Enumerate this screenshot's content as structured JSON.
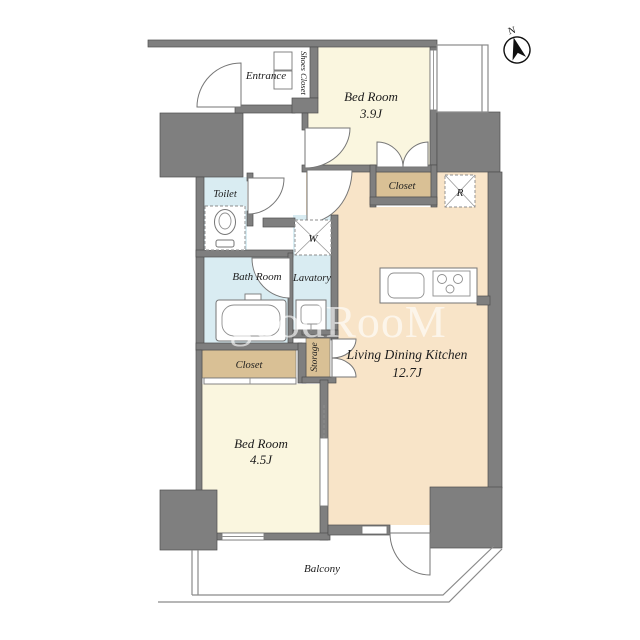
{
  "plan": {
    "compass": {
      "north_label": "N"
    },
    "watermark_text": "goodRooM",
    "rooms": {
      "entrance": {
        "label": "Entrance"
      },
      "shoes_closet": {
        "label": "Shoes Closet"
      },
      "bedroom_north": {
        "label": "Bed Room",
        "size": "3.9J"
      },
      "bedroom_north_closet": {
        "label": "Closet"
      },
      "toilet": {
        "label": "Toilet"
      },
      "bath": {
        "label": "Bath Room"
      },
      "lavatory": {
        "label": "Lavatory"
      },
      "ldk": {
        "label": "Living Dining Kitchen",
        "size": "12.7J"
      },
      "storage": {
        "label": "Storage"
      },
      "bedroom_south_closet": {
        "label": "Closet"
      },
      "bedroom_south": {
        "label": "Bed Room",
        "size": "4.5J"
      },
      "balcony": {
        "label": "Balcony"
      }
    },
    "appliance_marks": {
      "washing_machine": "W",
      "refrigerator": "R"
    },
    "colors": {
      "wall": "#7f7f7f",
      "bedroom_floor": "#faf6df",
      "ldk_floor": "#f8e4c8",
      "closet_floor": "#d9c095",
      "wet_area_floor": "#d9ecf2",
      "background": "#ffffff"
    }
  }
}
